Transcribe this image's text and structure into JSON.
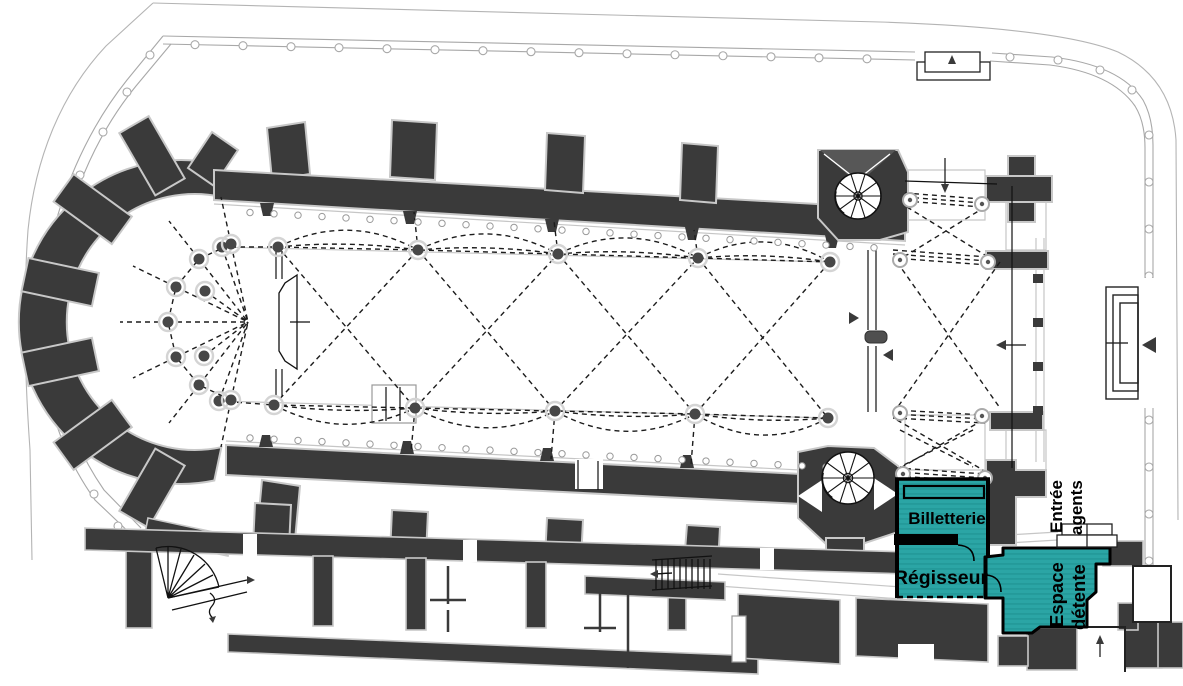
{
  "plan": {
    "rooms": {
      "billetterie": {
        "label": "Billetterie",
        "highlighted": true
      },
      "regisseur": {
        "label": "Régisseur",
        "highlighted": true
      },
      "espace_detente": {
        "label_line1": "Espace",
        "label_line2": "détente",
        "highlighted": true
      },
      "entree_agents": {
        "label_line1": "Entrée",
        "label_line2": "agents"
      }
    },
    "colors": {
      "highlight": "#2ba5a5",
      "highlight_stripe": "#1f9494",
      "wall": "#3a3a3a",
      "boundary": "#b4b4b4",
      "detail_line": "#1c1c1c",
      "background": "#ffffff"
    }
  }
}
